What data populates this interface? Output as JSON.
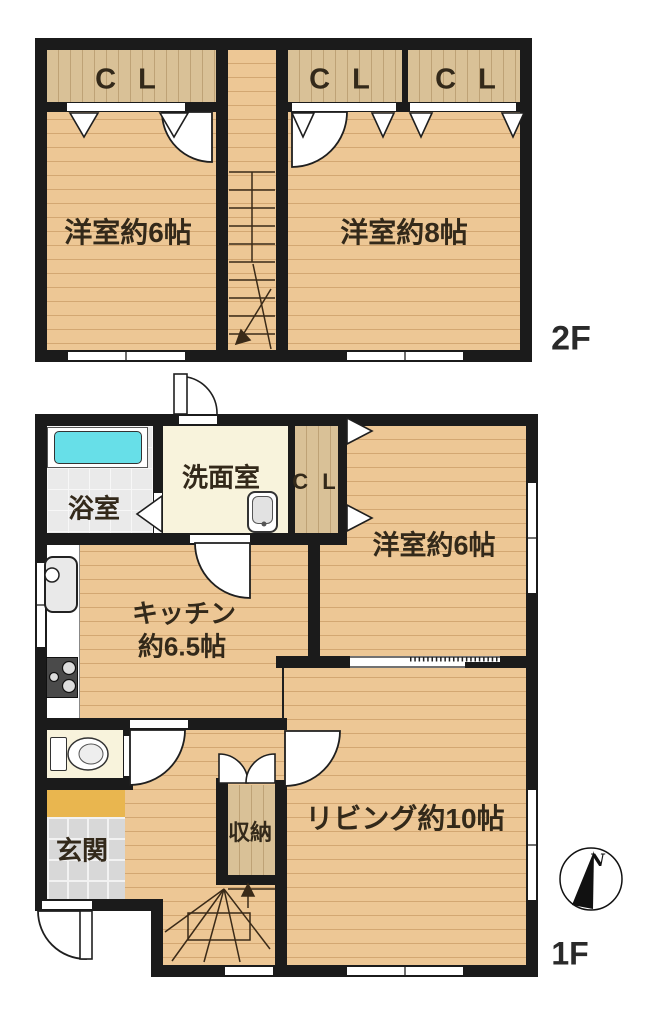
{
  "labels": {
    "cl": "C L",
    "bedroom6_2f": "洋室約6帖",
    "bedroom8_2f": "洋室約8帖",
    "floor_2f": "2F",
    "washroom": "洗面室",
    "bathroom": "浴室",
    "bedroom6_1f": "洋室約6帖",
    "kitchen_l1": "キッチン",
    "kitchen_l2": "約6.5帖",
    "living": "リビング約10帖",
    "entrance": "玄関",
    "storage": "収納",
    "floor_1f": "1F",
    "north": "N"
  },
  "colors": {
    "wall": "#1b1b1b",
    "wood_floor": "#edc795",
    "closet_wood": "#d9c197",
    "cream_floor": "#f8f3dc",
    "bath_tile": "#eaeaea",
    "entrance_tile": "#d8d8d8",
    "entrance_step": "#e9b64f",
    "bathtub": "#67dfe8"
  }
}
